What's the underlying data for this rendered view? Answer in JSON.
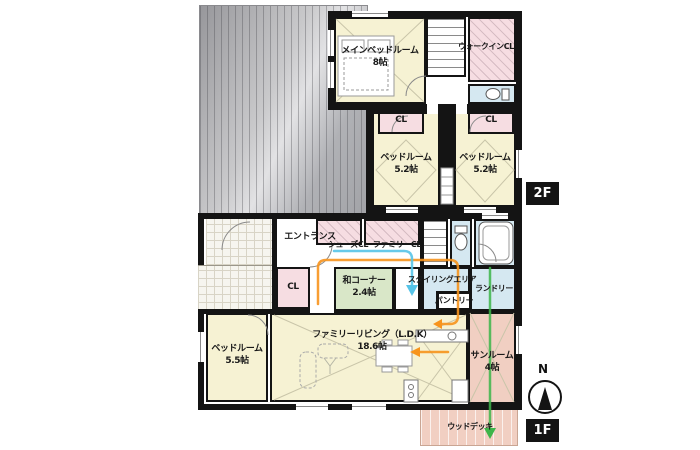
{
  "plan": {
    "floors": {
      "f2": {
        "badge": "2F",
        "rooms": {
          "main_bedroom": {
            "name": "メインベッドルーム",
            "size": "8帖"
          },
          "walk_in_closet": {
            "name": "ウォークインCL"
          },
          "closet_a": {
            "name": "CL"
          },
          "closet_b": {
            "name": "CL"
          },
          "bedroom_a": {
            "name": "ベッドルーム",
            "size": "5.2帖"
          },
          "bedroom_b": {
            "name": "ベッドルーム",
            "size": "5.2帖"
          }
        }
      },
      "f1": {
        "badge": "1F",
        "rooms": {
          "entrance": {
            "name": "エントランス"
          },
          "shoes_closet": {
            "name": "シューズCL"
          },
          "family_closet": {
            "name": "ファミリーCL"
          },
          "closet": {
            "name": "CL"
          },
          "wa_corner": {
            "name": "和コーナー",
            "size": "2.4帖"
          },
          "styling_area": {
            "name": "スタイリングエリア"
          },
          "pantry": {
            "name": "パントリー"
          },
          "laundry": {
            "name": "ランドリー"
          },
          "bedroom": {
            "name": "ベッドルーム",
            "size": "5.5帖"
          },
          "living": {
            "name": "ファミリーリビング（L.D.K）",
            "size": "18.6帖"
          },
          "sunroom": {
            "name": "サンルーム",
            "size": "4帖"
          },
          "wood_deck": {
            "name": "ウッドデッキ"
          }
        }
      }
    },
    "compass": {
      "north": "N"
    },
    "colors": {
      "room_yellow": "#f6f2d3",
      "room_pink": "#f6dde2",
      "room_blue": "#d5e8f1",
      "room_green": "#d9e7c8",
      "room_salmon": "#f1cfc2",
      "wall": "#141414",
      "flow_orange": "#f7941d",
      "flow_cyan": "#56c4e8",
      "flow_green": "#3db54a"
    }
  }
}
